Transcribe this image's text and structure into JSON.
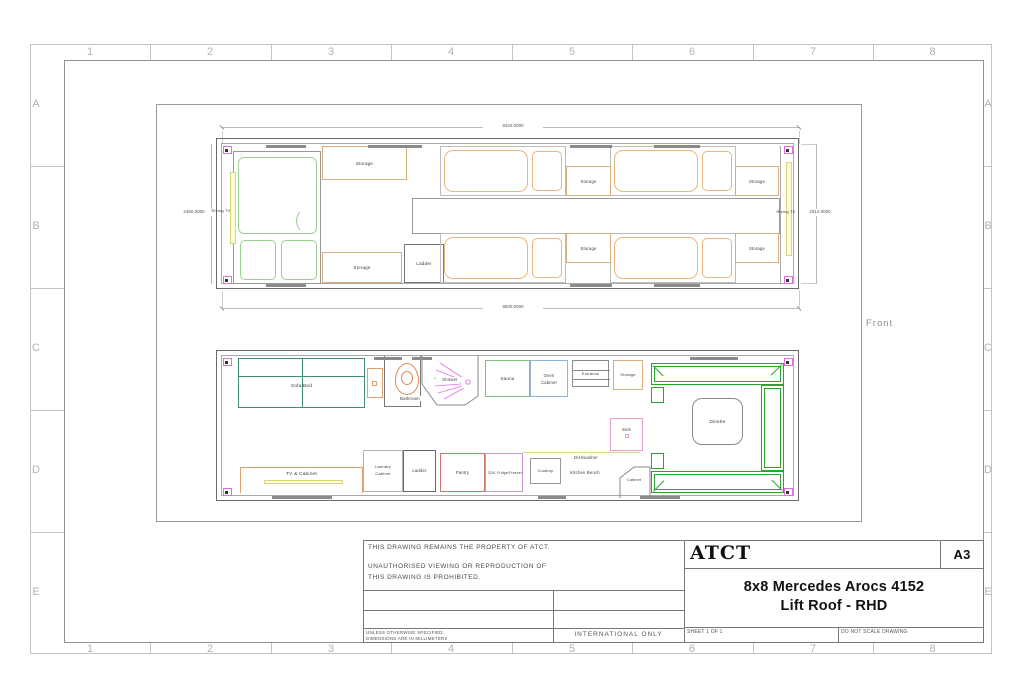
{
  "colors": {
    "wall": "#6b6b6b",
    "wall_inner": "#a8a8a8",
    "bed_orange": "#e9b77d",
    "master_green": "#9ccf92",
    "sofa_teal": "#3f8f78",
    "dinette_green": "#2aa52a",
    "tan": "#d8ae7e",
    "magenta": "#e86ee8",
    "pink": "#e8a0c8",
    "corner_magenta": "#e070e0",
    "yellow_border": "#d6d67a",
    "yellow_fill": "#fcfcdc",
    "blue": "#8fb3d9",
    "sauna_green": "#7fbf7f",
    "red": "#cc7766",
    "violet": "#cc99cc",
    "toilet_orange": "#e08858",
    "basin_orange": "#e0a070",
    "bench_yellow": "#ddda90"
  },
  "sheet": {
    "cols": [
      "1",
      "2",
      "3",
      "4",
      "5",
      "6",
      "7",
      "8"
    ],
    "rows": [
      "A",
      "B",
      "C",
      "D",
      "E"
    ],
    "front_label": "Front"
  },
  "shared": {
    "storage": "Storage",
    "ladder": "Ladder",
    "rising_tv": "Rising TV"
  },
  "upper_plan": {
    "dim_top": "9432.0000",
    "dim_bottom": "9600.0000",
    "dim_left": "2460.0000",
    "dim_right": "2312.0000"
  },
  "lower_plan": {
    "sofa_bed": "Sofa/Bed",
    "bathroom": "Bathroom",
    "shower": "Shower",
    "sauna": "Sauna",
    "oven_line1": "Oven",
    "oven_line2": "Cabinet",
    "entrance": "Entrance",
    "sink": "Sink",
    "dinette": "Dinette",
    "tv_cabinet": "TV & Cabinet",
    "laundry_line1": "Laundry",
    "laundry_line2": "Cabinet",
    "pantry": "Pantry",
    "fridge": "320L Fridge/Freezer",
    "cooktop": "Cooktop",
    "dishwasher": "Dishwasher",
    "kitchen_bench": "Kitchen Bench",
    "cabinet": "Cabinet"
  },
  "title_block": {
    "property_line1": "THIS DRAWING REMAINS THE PROPERTY OF ATCT.",
    "property_line2": "UNAUTHORISED VIEWING OR REPRODUCTION OF",
    "property_line3": "THIS DRAWING IS PROHIBITED.",
    "tolerance_line1": "UNLESS OTHERWISE SPECIFIED:",
    "tolerance_line2": "DIMENSIONS ARE IN MILLIMETERS",
    "international": "INTERNATIONAL ONLY",
    "logo": "ATCT",
    "paper_size": "A3",
    "title_line1": "8x8 Mercedes Arocs 4152",
    "title_line2": "Lift Roof - RHD",
    "sheet_info": "SHEET 1 OF 1",
    "scale_note": "DO NOT SCALE DRAWING"
  }
}
